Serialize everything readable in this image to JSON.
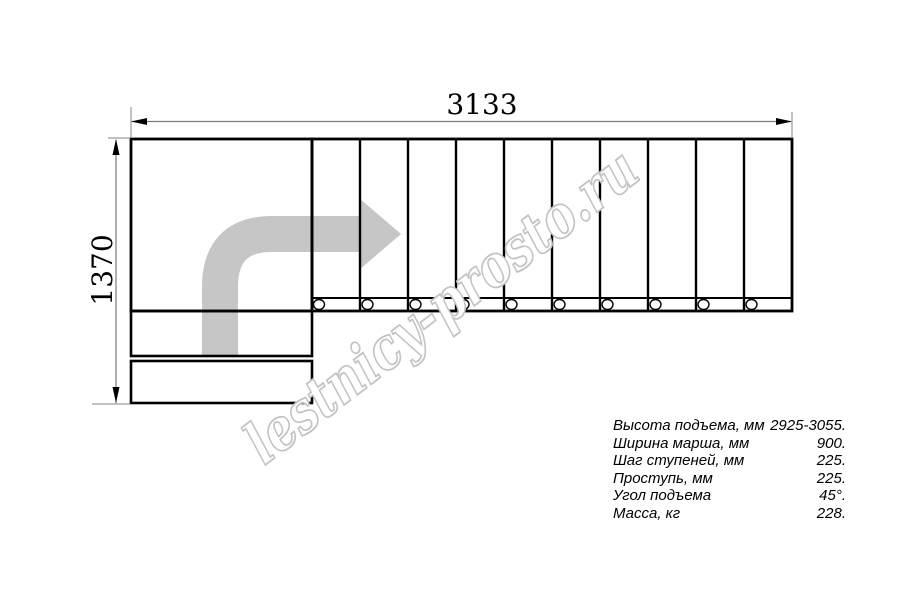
{
  "diagram": {
    "width_label": "3133",
    "height_label": "1370",
    "plan": {
      "tread_count": 10,
      "entry_step_count": 2,
      "baluster_circle_count": 10,
      "turn_direction": "up-then-right"
    }
  },
  "watermark": {
    "text": "lestnicy-prosto.ru"
  },
  "specs": {
    "rows": [
      {
        "label": "Высота подъема, мм",
        "value": "2925-3055."
      },
      {
        "label": "Ширина марша, мм",
        "value": "900."
      },
      {
        "label": "Шаг ступеней, мм",
        "value": "225."
      },
      {
        "label": "Проступь, мм",
        "value": "225."
      },
      {
        "label": "Угол подъема",
        "value": "45°."
      },
      {
        "label": "Масса, кг",
        "value": "228."
      }
    ]
  },
  "colors": {
    "line": "#000000",
    "dimension_line": "#8a8a8a",
    "arrow_fill": "#c6c6c6",
    "watermark_stroke": "#c3c3c3",
    "background": "#ffffff"
  }
}
